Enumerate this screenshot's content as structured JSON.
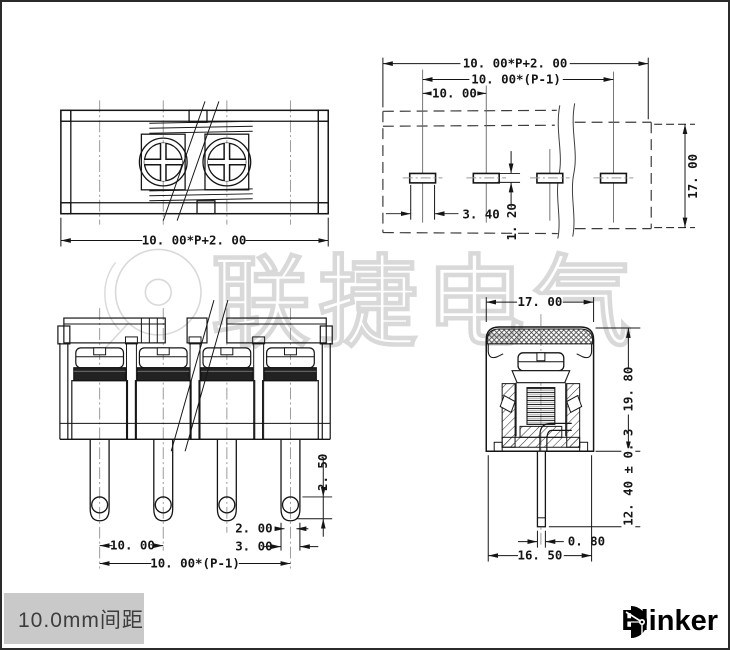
{
  "page": {
    "background": "#ffffff",
    "border_color": "#2b2b2b"
  },
  "watermark": {
    "text": "联捷电气",
    "color": "#d9d9d9"
  },
  "views": {
    "top": {
      "dim_overall": "10. 00*P+2. 00"
    },
    "pcb": {
      "dim_overall": "10. 00*P+2. 00",
      "dim_span": "10. 00*(P-1)",
      "dim_pitch": "10. 00",
      "dim_slot_width": "3. 40",
      "dim_slot_height": "1. 20",
      "dim_board_width": "17. 00"
    },
    "front": {
      "dim_hole_to_tip": "2. 50",
      "dim_pin_inner": "2. 00",
      "dim_pin_outer": "3. 00",
      "dim_pitch": "10. 00",
      "dim_span": "10. 00*(P-1)"
    },
    "side": {
      "dim_width": "17. 00",
      "dim_height": "19. 80",
      "dim_pin_length": "12. 40 ± 0. 3",
      "dim_pin_width": "0. 80",
      "dim_base": "16. 50"
    }
  },
  "footer": {
    "pitch_label": "10.0mm间距",
    "brand": "Elinker"
  }
}
